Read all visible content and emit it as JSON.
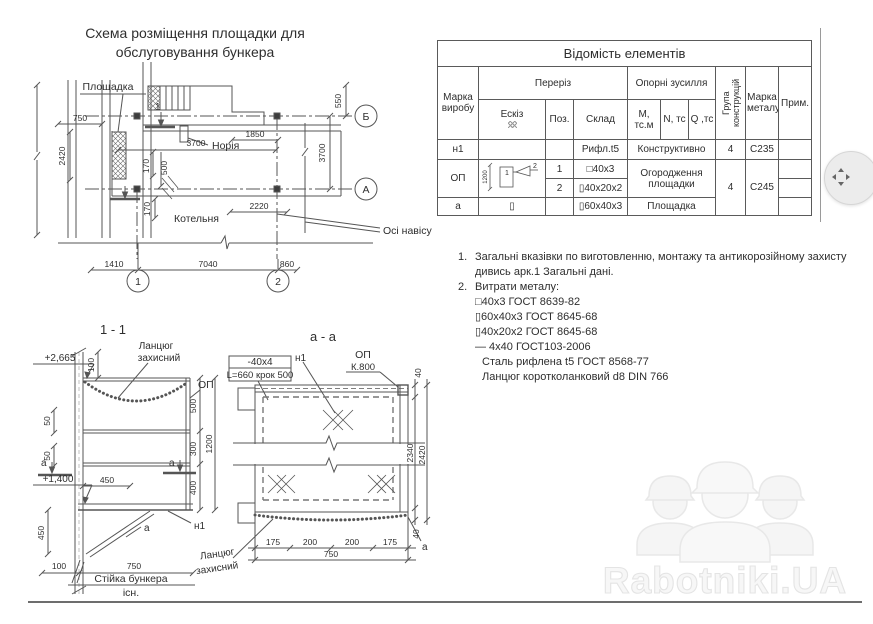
{
  "watermark": {
    "brand": "Rabotniki.UA"
  },
  "plan": {
    "title_line1": "Схема розміщення площадки для",
    "title_line2": "обслуговування бункера",
    "labels": {
      "ploshchadka": "Площадка",
      "noriya": "Норія",
      "kotelnya": "Котельня",
      "osi_navisu": "Осі навісу",
      "cut_mark": "1"
    },
    "dims": {
      "d750": "750",
      "d2420": "2420",
      "d3700_h": "3700",
      "d550": "550",
      "d1850": "1850",
      "d170a": "170",
      "d500": "500",
      "d170b": "170",
      "d2220": "2220",
      "d1410": "1410",
      "d7040": "7040",
      "d860": "860",
      "d3700_v": "3700"
    },
    "axes": {
      "a1": "1",
      "a2": "2",
      "aA": "А",
      "aB": "Б"
    }
  },
  "table": {
    "title": "Відомість елементів",
    "headers": {
      "marka_vyrobu": "Марка виробу",
      "pereriz": "Переріз",
      "eskiz": "Ескіз",
      "poz": "Поз.",
      "sklad": "Склад",
      "oporni": "Опорні зусилля",
      "m": "М, тс.м",
      "n": "N, тс",
      "q": "Q ,тс",
      "grupa": "Група конструкцій",
      "marka_metalu": "Марка металу",
      "prym": "Прим."
    },
    "rows": {
      "n1": {
        "marka": "н1",
        "sklad": "Рифл.t5",
        "oporni": "Конструктивно",
        "grupa": "4",
        "metal": "С235"
      },
      "op": {
        "marka": "ОП",
        "eskiz_dim": "1200",
        "eskiz_p1": "1",
        "eskiz_p2": "2",
        "poz1": "1",
        "sklad1": "□40x3",
        "poz2": "2",
        "sklad2": "▯40x20x2",
        "oporni": "Огородження площадки",
        "grupa": "4",
        "metal": "С245"
      },
      "a": {
        "marka": "а",
        "eskiz": "▯",
        "sklad": "▯60x40x3",
        "oporni": "Площадка"
      }
    }
  },
  "notes": {
    "n1_num": "1.",
    "n1_line1": "Загальні вказівки по виготовленню, монтажу та антикорозійному захисту",
    "n1_line2": "дивись арк.1 Загальні дані.",
    "n2_num": "2.",
    "n2_title": "Витрати металу:",
    "items": [
      "□40x3 ГОСТ 8639-82",
      "▯60x40x3  ГОСТ 8645-68",
      "▯40x20x2  ГОСТ 8645-68",
      "— 4x40 ГОСТ103-2006",
      "Сталь рифлена t5 ГОСТ 8568-77",
      "Ланцюг коротколанковий d8 DIN 766"
    ]
  },
  "section11": {
    "title": "1 - 1",
    "elev_top": "+2,665",
    "elev_mid": "+1,400",
    "chain_l1": "Ланцюг",
    "chain_l2": "захисний",
    "op": "ОП",
    "n1": "н1",
    "a_left": "а",
    "a_right": "а",
    "a_brace": "а",
    "stiyka_l1": "Стійка бункера",
    "stiyka_l2": "існ.",
    "d100_top": "100",
    "d50_1": "50",
    "d50_2": "50",
    "d500": "500",
    "d300": "300",
    "d400": "400",
    "d1200": "1200",
    "d450_h": "450",
    "d450_v": "450",
    "d100_bot": "100",
    "d750": "750"
  },
  "sectionAA": {
    "title": "а - а",
    "strip_l1": "-40x4",
    "strip_l2": "L=660 крок 500",
    "n1": "н1",
    "op_l1": "ОП",
    "op_l2": "К.800",
    "chain_l1": "Ланцюг",
    "chain_l2": "захисний",
    "a_mark": "а",
    "d40_top": "40",
    "d2340": "2340",
    "d2420": "2420",
    "d40_bot": "40",
    "d175_1": "175",
    "d200_1": "200",
    "d200_2": "200",
    "d175_2": "175",
    "d750": "750"
  }
}
